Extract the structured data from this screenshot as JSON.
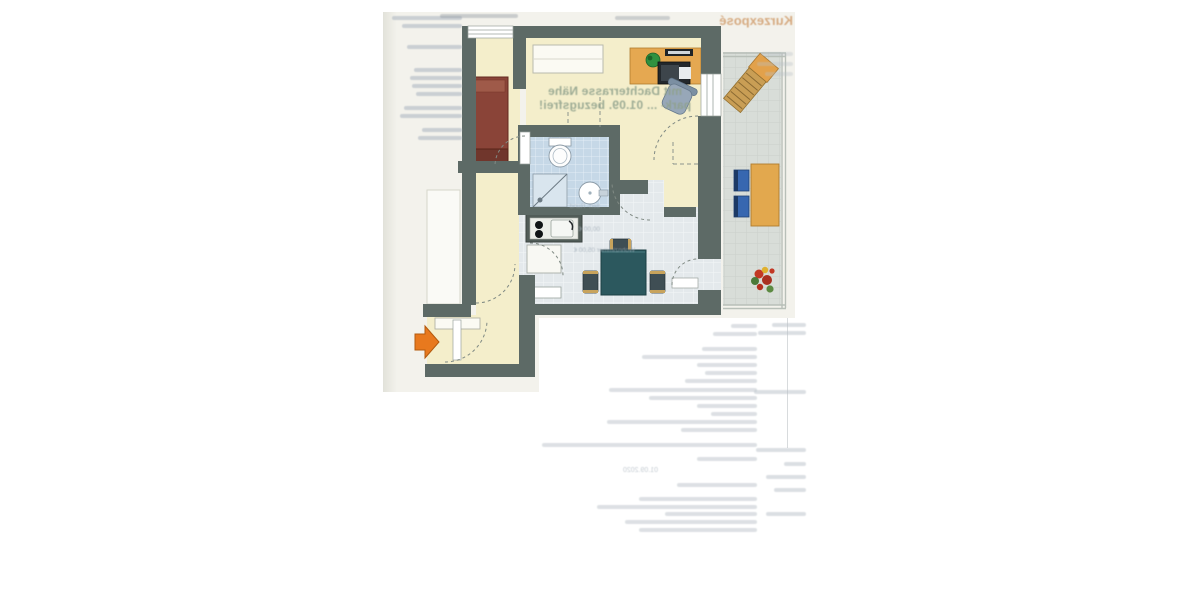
{
  "page": {
    "background": "#ffffff",
    "scan_background": "#f3f2ec"
  },
  "bleedthrough": {
    "brand": "Kurzexposé",
    "headline_line1": "mit Dachterrasse Nähe",
    "headline_line2": "park- ... 01.09. bezugsfrei!",
    "rent_fragment_1": "tten- Rund",
    "rent_fragment_2": "00,00 €",
    "rent_fragment_3": "Wohnzimmer  05,00 €",
    "date": "01.09.2020"
  },
  "floorplan": {
    "colors": {
      "wall": "#5d6a66",
      "floor_cream": "#f4eecb",
      "tile_bathroom": "#c6d8e7",
      "tile_kitchen": "#e4e9ec",
      "tile_terrace": "#d8ddd8",
      "bed": "#8a4438",
      "wood_furniture": "#e3a750",
      "dining_table": "#2c585e",
      "terrace_chair_blue": "#3767b0",
      "entrance_arrow": "#e8791e"
    },
    "furniture": [
      "bed",
      "sideboard",
      "desk",
      "computer-monitor",
      "keyboard",
      "desk-plant",
      "office-chair",
      "toilet",
      "shower",
      "washbasin",
      "kitchenette-stove-sink",
      "kitchen-appliance",
      "dining-table",
      "dining-chairs",
      "entry-shelf",
      "terrace-lounger",
      "terrace-table",
      "terrace-chairs",
      "flower-pot",
      "entrance-arrow"
    ]
  }
}
